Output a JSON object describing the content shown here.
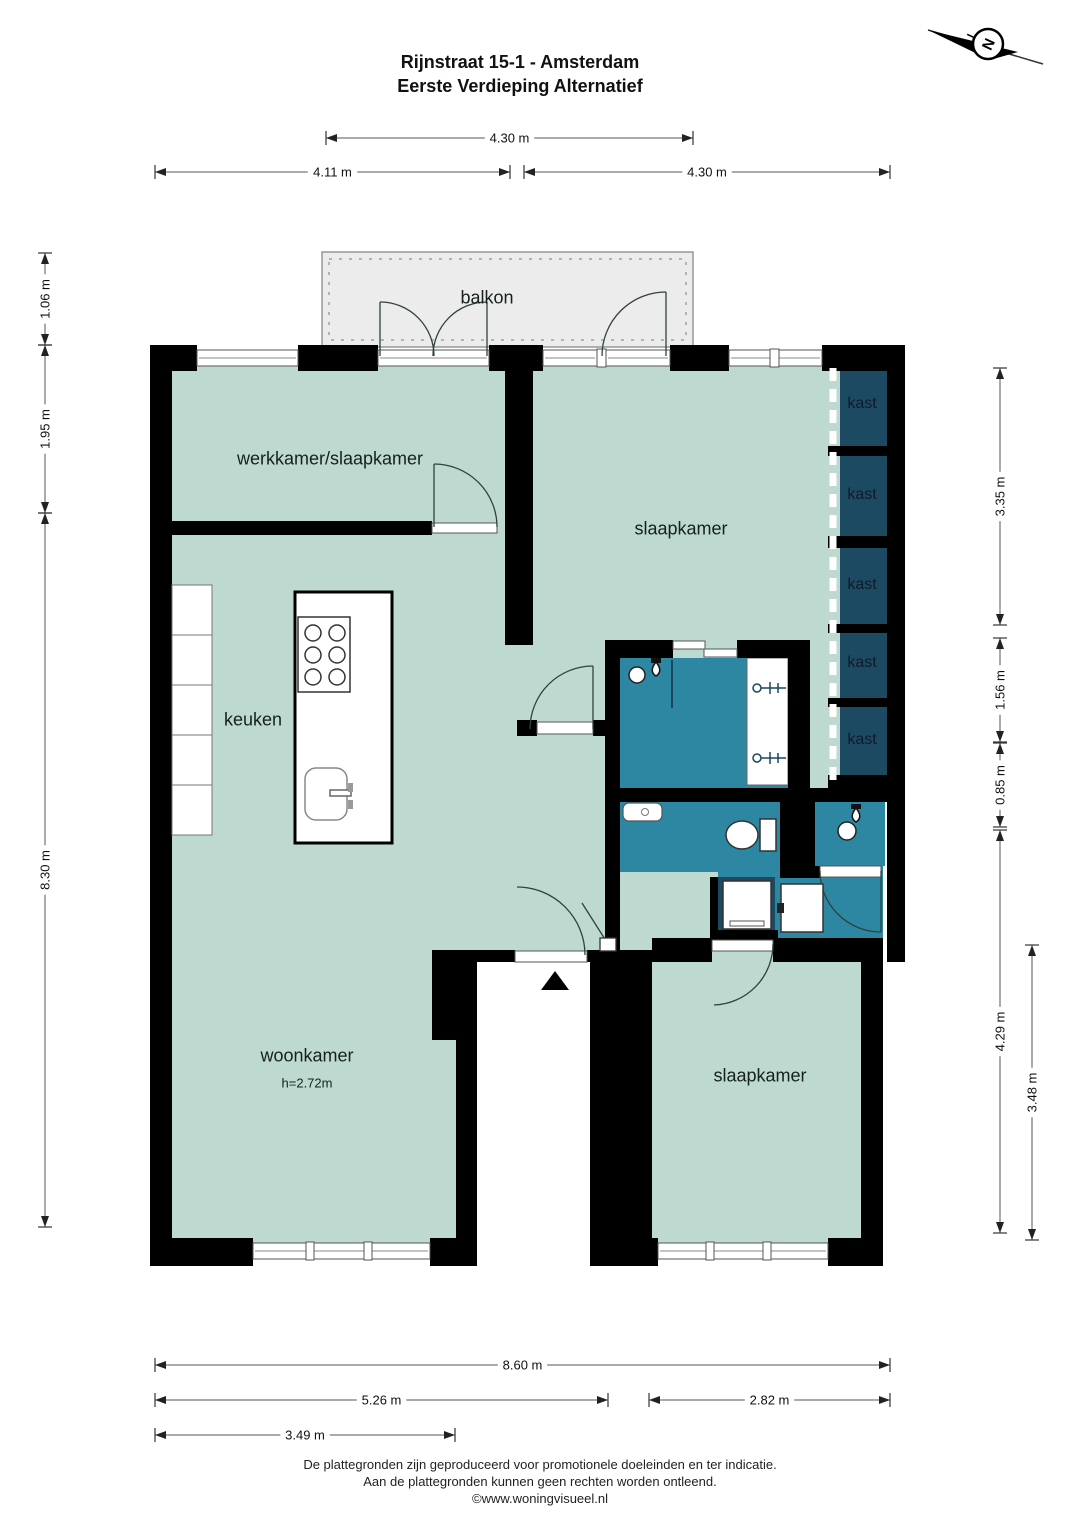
{
  "title": {
    "line1": "Rijnstraat 15-1 - Amsterdam",
    "line2": "Eerste Verdieping Alternatief"
  },
  "compass": {
    "letter": "N"
  },
  "rooms": [
    {
      "id": "balkon",
      "label": "balkon",
      "x": 487,
      "y": 298,
      "cls": "lg"
    },
    {
      "id": "werkkamer-slaapkamer",
      "label": "werkkamer/slaapkamer",
      "x": 330,
      "y": 459,
      "cls": "lg"
    },
    {
      "id": "slaapkamer-boven",
      "label": "slaapkamer",
      "x": 681,
      "y": 529,
      "cls": "lg"
    },
    {
      "id": "kast-1",
      "label": "kast",
      "x": 862,
      "y": 404,
      "cls": "md"
    },
    {
      "id": "kast-2",
      "label": "kast",
      "x": 862,
      "y": 495,
      "cls": "md"
    },
    {
      "id": "kast-3",
      "label": "kast",
      "x": 862,
      "y": 585,
      "cls": "md"
    },
    {
      "id": "kast-4",
      "label": "kast",
      "x": 862,
      "y": 663,
      "cls": "md"
    },
    {
      "id": "kast-5",
      "label": "kast",
      "x": 862,
      "y": 740,
      "cls": "md"
    },
    {
      "id": "keuken",
      "label": "keuken",
      "x": 253,
      "y": 720,
      "cls": "lg"
    },
    {
      "id": "woonkamer",
      "label": "woonkamer",
      "x": 307,
      "y": 1056,
      "cls": "lg"
    },
    {
      "id": "woonkamer-hoogte",
      "label": "h=2.72m",
      "x": 307,
      "y": 1083,
      "cls": "sm"
    },
    {
      "id": "slaapkamer-beneden",
      "label": "slaapkamer",
      "x": 760,
      "y": 1076,
      "cls": "lg"
    }
  ],
  "dimensions": {
    "horizontal": [
      {
        "label": "4.30 m",
        "x1": 326,
        "x2": 693,
        "y": 138
      },
      {
        "label": "4.11 m",
        "x1": 155,
        "x2": 510,
        "y": 172
      },
      {
        "label": "4.30 m",
        "x1": 524,
        "x2": 890,
        "y": 172
      },
      {
        "label": "8.60 m",
        "x1": 155,
        "x2": 890,
        "y": 1365
      },
      {
        "label": "5.26 m",
        "x1": 155,
        "x2": 608,
        "y": 1400
      },
      {
        "label": "2.82 m",
        "x1": 649,
        "x2": 890,
        "y": 1400
      },
      {
        "label": "3.49 m",
        "x1": 155,
        "x2": 455,
        "y": 1435
      }
    ],
    "vertical": [
      {
        "label": "1.06 m",
        "y1": 253,
        "y2": 345,
        "x": 45
      },
      {
        "label": "1.95 m",
        "y1": 345,
        "y2": 513,
        "x": 45
      },
      {
        "label": "8.30 m",
        "y1": 513,
        "y2": 1227,
        "x": 45
      },
      {
        "label": "3.35 m",
        "y1": 368,
        "y2": 625,
        "x": 1000
      },
      {
        "label": "1.56 m",
        "y1": 638,
        "y2": 742,
        "x": 1000
      },
      {
        "label": "0.85 m",
        "y1": 743,
        "y2": 827,
        "x": 1000
      },
      {
        "label": "4.29 m",
        "y1": 830,
        "y2": 1233,
        "x": 1000
      },
      {
        "label": "3.48 m",
        "y1": 945,
        "y2": 1240,
        "x": 1032
      }
    ]
  },
  "footer": {
    "line1": "De plattegronden zijn geproduceerd voor promotionele doeleinden en ter indicatie.",
    "line2": "Aan de plattegronden kunnen geen rechten worden ontleend.",
    "line3": "©www.woningvisueel.nl"
  },
  "colors": {
    "room": "#bedad0",
    "wet": "#2e87a2",
    "closet": "#1d4a63",
    "balcony": "#ececec",
    "wall": "#000000"
  }
}
